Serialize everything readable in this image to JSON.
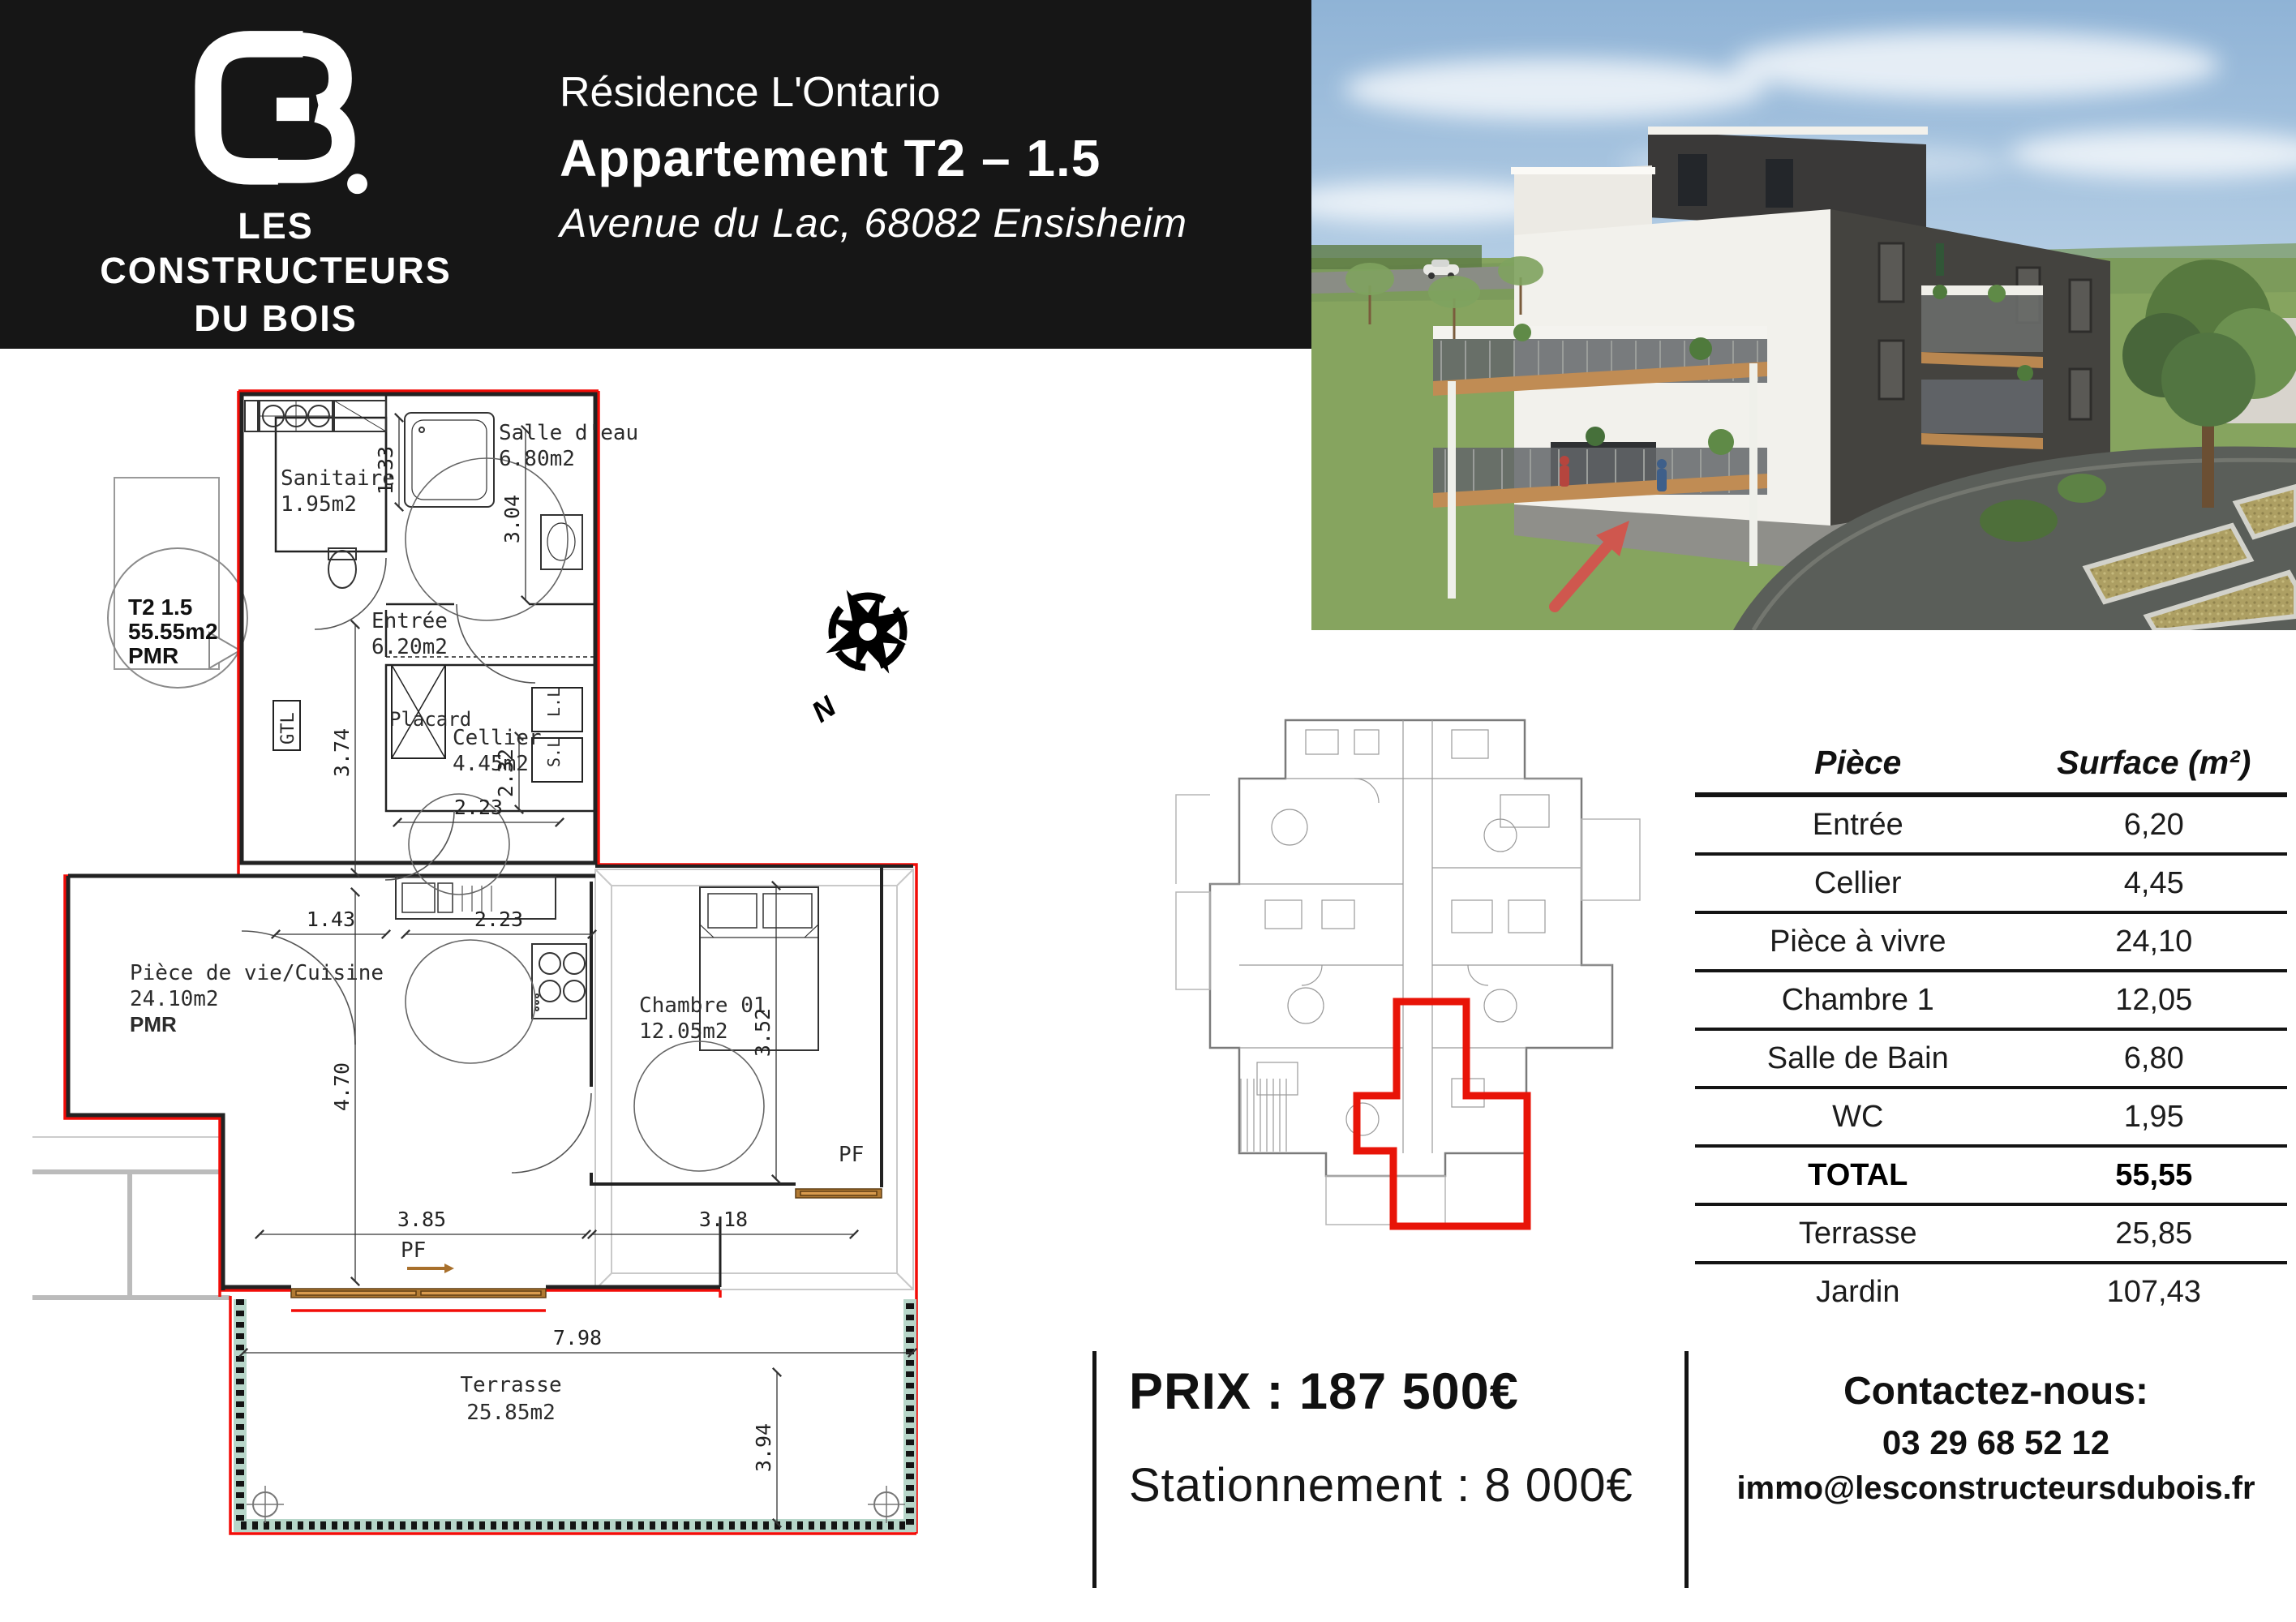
{
  "header": {
    "logo": {
      "monogram": "CB.",
      "name_line1": "LES CONSTRUCTEURS",
      "name_line2": "DU BOIS"
    },
    "residence": "Résidence L'Ontario",
    "apartment": "Appartement T2 – 1.5",
    "address": "Avenue du Lac, 68082 Ensisheim"
  },
  "floor_plan": {
    "unit_bubble": {
      "line1": "T2 1.5",
      "line2": "55.55m2",
      "line3": "PMR"
    },
    "rooms": {
      "salle_eau": {
        "name": "Salle d'eau",
        "area": "6.80m2"
      },
      "sanitaire": {
        "name": "Sanitaire",
        "area": "1.95m2"
      },
      "entree": {
        "name": "Entrée",
        "area": "6.20m2"
      },
      "placard": {
        "name": "Placard"
      },
      "cellier": {
        "name": "Cellier",
        "area": "4.45m2"
      },
      "piece_vie": {
        "name": "Pièce de vie/Cuisine",
        "area": "24.10m2",
        "note": "PMR"
      },
      "chambre": {
        "name": "Chambre 01",
        "area": "12.05m2"
      },
      "terrasse": {
        "name": "Terrasse",
        "area": "25.85m2"
      }
    },
    "annotations": {
      "gtl": "GTL",
      "ll": "L.L",
      "sl": "S.L",
      "pf1": "PF",
      "pf2": "PF",
      "north": "N"
    },
    "dimensions": {
      "d1": "1.33",
      "d2": "3.04",
      "d3": "1.43",
      "d4": "2.23",
      "d5": "3.74",
      "d6": "2.32",
      "d7": "2.23",
      "d8": "4.70",
      "d9": "3.52",
      "d10": "3.85",
      "d11": "3.18",
      "d12": "7.98",
      "d13": "3.94"
    }
  },
  "surface_table": {
    "headers": {
      "piece": "Pièce",
      "surface": "Surface (m²)"
    },
    "rows": [
      {
        "piece": "Entrée",
        "surface": "6,20"
      },
      {
        "piece": "Cellier",
        "surface": "4,45"
      },
      {
        "piece": "Pièce à vivre",
        "surface": "24,10"
      },
      {
        "piece": "Chambre 1",
        "surface": "12,05"
      },
      {
        "piece": "Salle de Bain",
        "surface": "6,80"
      },
      {
        "piece": "WC",
        "surface": "1,95"
      },
      {
        "piece": "TOTAL",
        "surface": "55,55"
      },
      {
        "piece": "Terrasse",
        "surface": "25,85"
      },
      {
        "piece": "Jardin",
        "surface": "107,43"
      }
    ]
  },
  "pricing": {
    "price": "PRIX : 187 500€",
    "parking": "Stationnement : 8 000€"
  },
  "contact": {
    "heading": "Contactez-nous:",
    "phone": "03 29 68 52 12",
    "email": "immo@lesconstructeursdubois.fr"
  },
  "colors": {
    "outline_red": "#f20d08",
    "highlight_red": "#e81408",
    "arrow_red": "#cf574e",
    "wood": "#a8702c",
    "hatch_teal": "#b7d6c9",
    "header_black": "#161616"
  }
}
